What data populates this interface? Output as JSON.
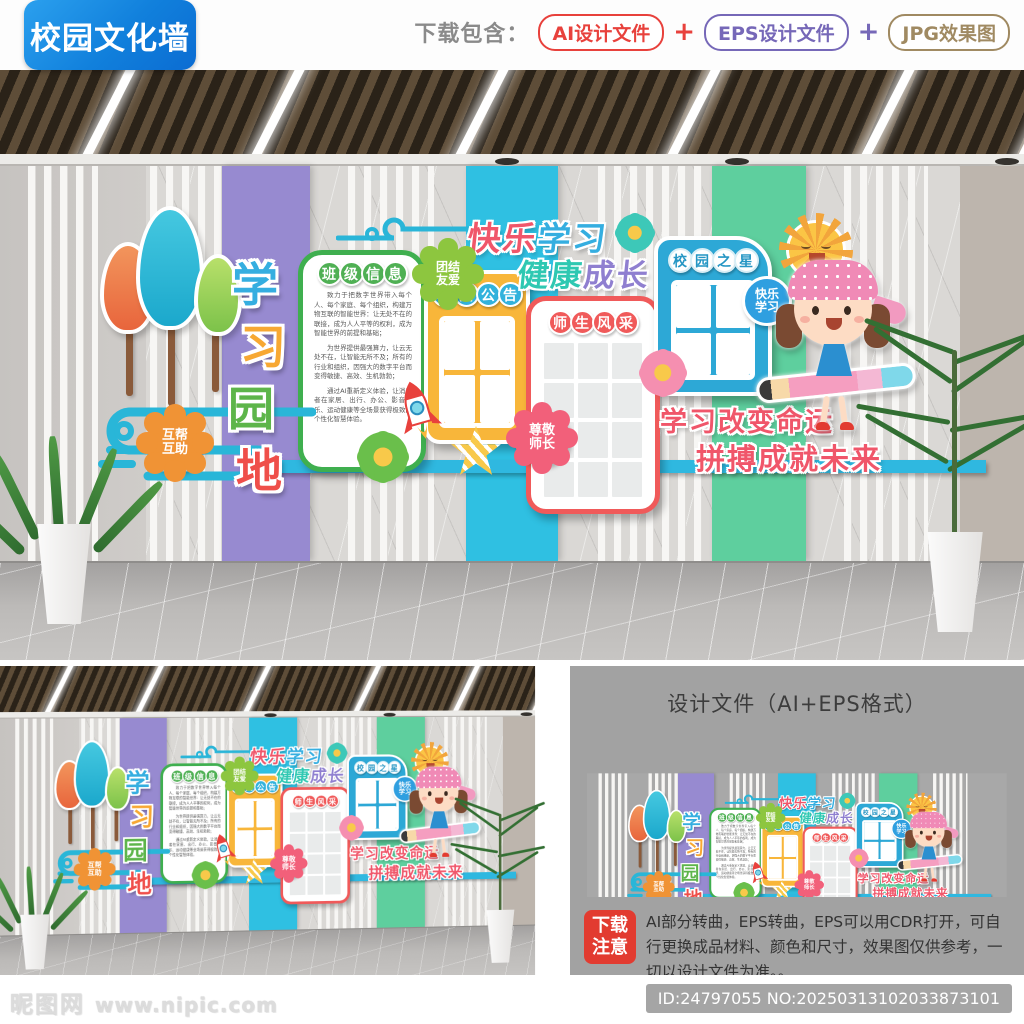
{
  "header": {
    "title_badge": "校园文化墙",
    "download_label": "下载包含：",
    "plus": "+",
    "pill_ai": "AI设计文件",
    "pill_eps": "EPS设计文件",
    "pill_jpg": "JPG效果图"
  },
  "colors": {
    "badge_blue_start": "#2ba0ee",
    "badge_blue_end": "#0b6cd2",
    "pill_red": "#e8413c",
    "pill_purple": "#7668b8",
    "pill_tan": "#a08a62",
    "stripe_purple": "#978ad0",
    "stripe_cyan": "#2fc0e2",
    "stripe_green": "#5ecf9e",
    "panel_green_border": "#3faf4f",
    "panel_yellow": "#f8b63a",
    "panel_red_border": "#f05a5a",
    "panel_blue": "#2da8d6",
    "slogan_red": "#f0566a",
    "slogan_blue": "#35aee0",
    "slogan_teal": "#2fc8b2",
    "slogan_purple": "#8f7fd0",
    "bar_blue": "#2fb8e0"
  },
  "wall": {
    "title_chars": [
      "学",
      "习",
      "园",
      "地"
    ],
    "slogan1_a": "快乐",
    "slogan1_b": "学习",
    "slogan2_a": "健康",
    "slogan2_b": "成长",
    "motto_line1": "学习改变命运",
    "motto_line2": "拼搏成就未来",
    "badge_unity_l1": "团结",
    "badge_unity_l2": "友爱",
    "badge_help_l1": "互帮",
    "badge_help_l2": "互助",
    "badge_respect_l1": "尊敬",
    "badge_respect_l2": "师长",
    "badge_happy_l1": "快乐",
    "badge_happy_l2": "学习",
    "panel_class": {
      "title_chars": [
        "班",
        "级",
        "信",
        "息"
      ],
      "para1": "致力于把数字世界带入每个人、每个家庭、每个组织，构建万物互联的智能世界：让无处不在的联接，成为人人平等的权利，成为智能世界的前提和基础；",
      "para2": "为世界提供最强算力，让云无处不在，让智能无所不及；所有的行业和组织，因强大的数字平台而变得敏捷、高效、生机勃勃；",
      "para3": "通过AI重新定义体验，让消费者在家居、出行、办公、影音娱乐、运动健康等全场景获得极致的个性化智慧体验。"
    },
    "panel_notice": {
      "title_chars": [
        "校",
        "园",
        "公",
        "告"
      ]
    },
    "panel_teachers": {
      "title_chars": [
        "师",
        "生",
        "风",
        "采"
      ]
    },
    "panel_star": {
      "title_chars": [
        "校",
        "园",
        "之",
        "星"
      ]
    }
  },
  "design_section": {
    "title": "设计文件（AI+EPS格式）",
    "notice_badge_l1": "下载",
    "notice_badge_l2": "注意",
    "notice_text": "AI部分转曲，EPS转曲，EPS可以用CDR打开，可自行更换成品材料、颜色和尺寸，效果图仅供参考，一切以设计文件为准。。"
  },
  "footer": {
    "watermark_name": "昵图网",
    "watermark_url": "www.nipic.com",
    "id_text": "ID:24797055 NO:20250313102033873101"
  }
}
